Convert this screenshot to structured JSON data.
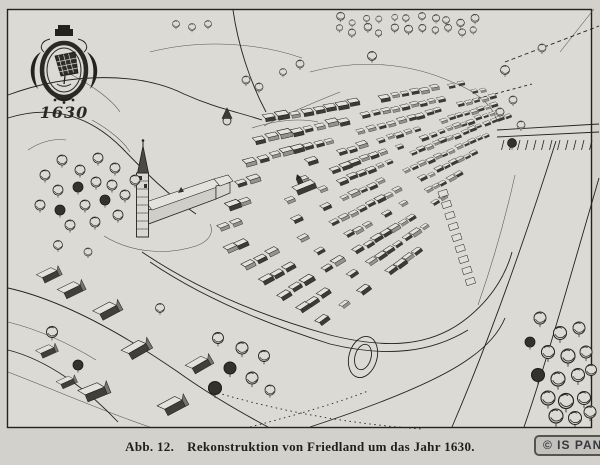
{
  "figure": {
    "cartouche_year": "1630",
    "caption_label": "Abb. 12.",
    "caption_text": "Rekonstruktion von Friedland um das Jahr 1630.",
    "watermark": "© IS PAN"
  },
  "scene": {
    "type": "bird's-eye reconstruction drawing of a walled town",
    "elements": [
      "coat-of-arms-cartouche",
      "church-with-spire",
      "gridded-house-blocks",
      "market-square-with-town-hall",
      "suburb-farmhouses",
      "bridge-with-piles",
      "roads-and-paths",
      "moat-and-pond",
      "tree-groves",
      "forest-band"
    ]
  },
  "colors": {
    "paper": "#dbdad5",
    "margin": "#d2d1cc",
    "ink": "#23221d",
    "badge_background": "#c2c1bc",
    "badge_border": "#55544f",
    "badge_text": "#38373f"
  }
}
